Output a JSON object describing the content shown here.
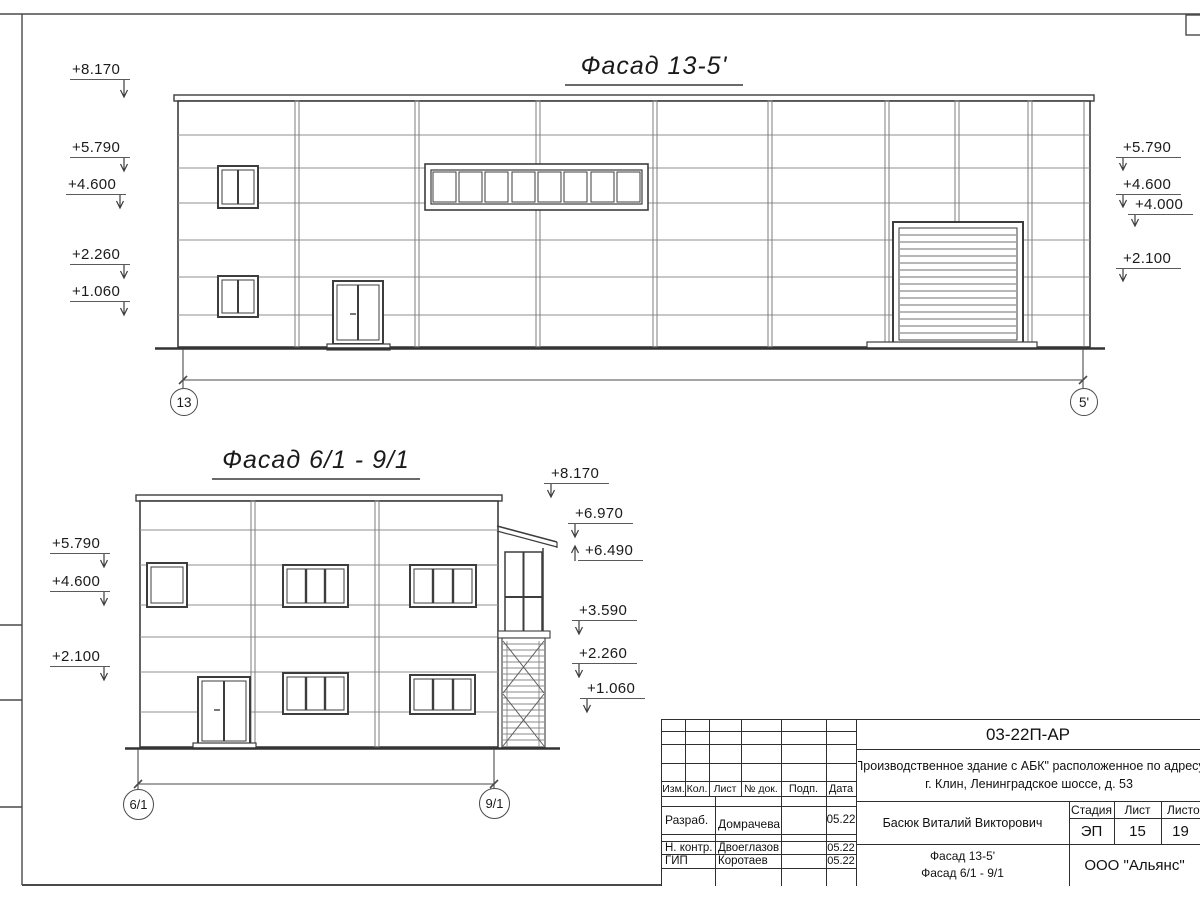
{
  "drawing": {
    "facade1": {
      "title": "Фасад 13-5'",
      "axis_left": "13",
      "axis_right": "5'",
      "marks_left": [
        "+8.170",
        "+5.790",
        "+4.600",
        "+2.260",
        "+1.060"
      ],
      "marks_right": [
        "+5.790",
        "+4.600",
        "+4.000",
        "+2.100"
      ]
    },
    "facade2": {
      "title": "Фасад 6/1 - 9/1",
      "axis_left": "6/1",
      "axis_right": "9/1",
      "marks_left": [
        "+5.790",
        "+4.600",
        "+2.100"
      ],
      "marks_right": [
        "+8.170",
        "+6.970",
        "+6.490",
        "+3.590",
        "+2.260",
        "+1.060"
      ]
    }
  },
  "titleblock": {
    "doc_number": "03-22П-АР",
    "project_line1": "\"Производственное здание с АБК\" расположенное по адресу:",
    "project_line2": "г. Клин, Ленинградское шоссе, д. 53",
    "col_izm": "Изм.",
    "col_kol": "Кол.",
    "col_list": "Лист",
    "col_doc": "№ док.",
    "col_podp": "Подп.",
    "col_data": "Дата",
    "row1_role": "Разраб.",
    "row1_name": "Домрачева",
    "row1_date": "05.22",
    "row2_role": "Н. контр.",
    "row2_name": "Двоеглазов",
    "row2_date": "05.22",
    "row3_role": "ГИП",
    "row3_name": "Коротаев",
    "row3_date": "05.22",
    "supervisor": "Басюк Виталий Викторович",
    "stage_label": "Стадия",
    "sheet_label": "Лист",
    "sheets_label": "Листов",
    "stage": "ЭП",
    "sheet_no": "15",
    "sheets_total": "19",
    "name_line1": "Фасад 13-5'",
    "name_line2": "Фасад 6/1 - 9/1",
    "company": "ООО \"Альянс\""
  }
}
